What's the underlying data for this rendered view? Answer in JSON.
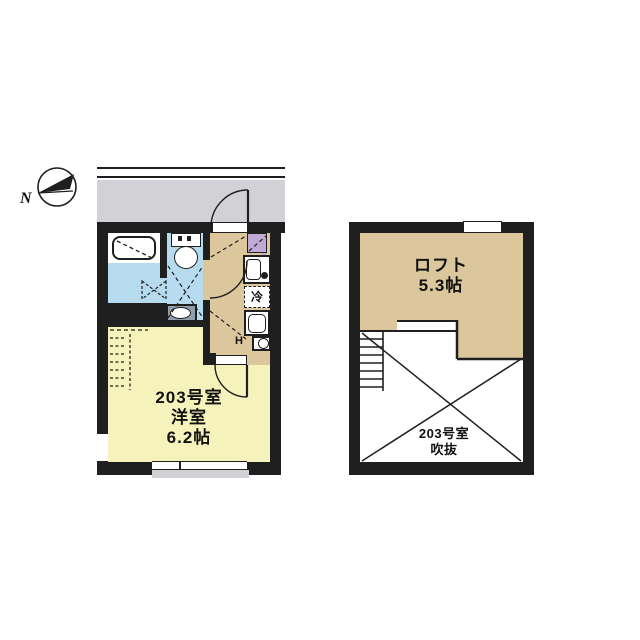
{
  "compass": {
    "north_label": "N"
  },
  "unit_plan": {
    "room_number": "203号室",
    "room_type": "洋室",
    "room_size": "6.2帖",
    "refrigerator_label": "冷",
    "water_heater_label": "H"
  },
  "loft_plan": {
    "loft_name": "ロフト",
    "loft_size": "5.3帖",
    "void_room_number": "203号室",
    "void_label": "吹抜"
  },
  "colors": {
    "wall_black": "#1f1f1f",
    "corridor_gray": "#d2d2d6",
    "wet_area_blue": "#b7dbee",
    "main_room_yellow": "#f6f2bb",
    "loft_tan": "#dcc79d",
    "closet_purple": "#c0a9d5"
  }
}
